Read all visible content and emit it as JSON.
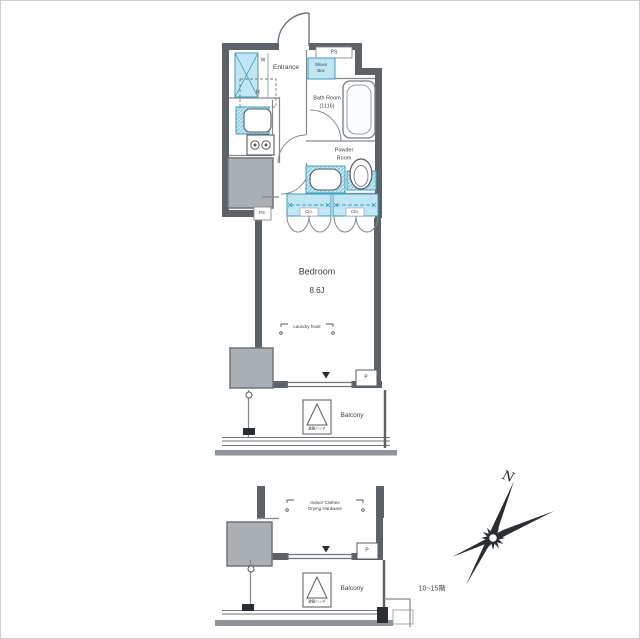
{
  "colors": {
    "wall": "#5d6267",
    "wall_line": "#84898e",
    "column_fill": "#aaafb4",
    "fixture_cyan": "#bfe6f2",
    "cyan_border": "#3f9cba",
    "band_gray": "#8e9499",
    "ink": "#2a2e32",
    "text": "#3b4045"
  },
  "upper_plan": {
    "entrance": "Entrance",
    "ps_top": "PS",
    "shoes_box": [
      "Shoes",
      "Box"
    ],
    "washer": "W",
    "refrigerator": "R",
    "bath_room": [
      "Bath Room",
      "(1116)"
    ],
    "powder_room": [
      "Powder",
      "Room"
    ],
    "closets": [
      "Clo.",
      "Clo."
    ],
    "ps_shaft": "PS",
    "bedroom": "Bedroom",
    "bedroom_size": "8.6J",
    "laundry_hook": "Laundry hook",
    "pipe_shaft": "P",
    "balcony": "Balcony",
    "evac_hatch": "避難ハッチ"
  },
  "lower_plan": {
    "drying_hardware": [
      "Indoor Clothes",
      "Drying Hardware"
    ],
    "pipe_shaft": "P",
    "balcony": "Balcony",
    "evac_hatch": "避難ハッチ",
    "floor_note": "10~15階"
  },
  "compass": {
    "north": "N"
  }
}
